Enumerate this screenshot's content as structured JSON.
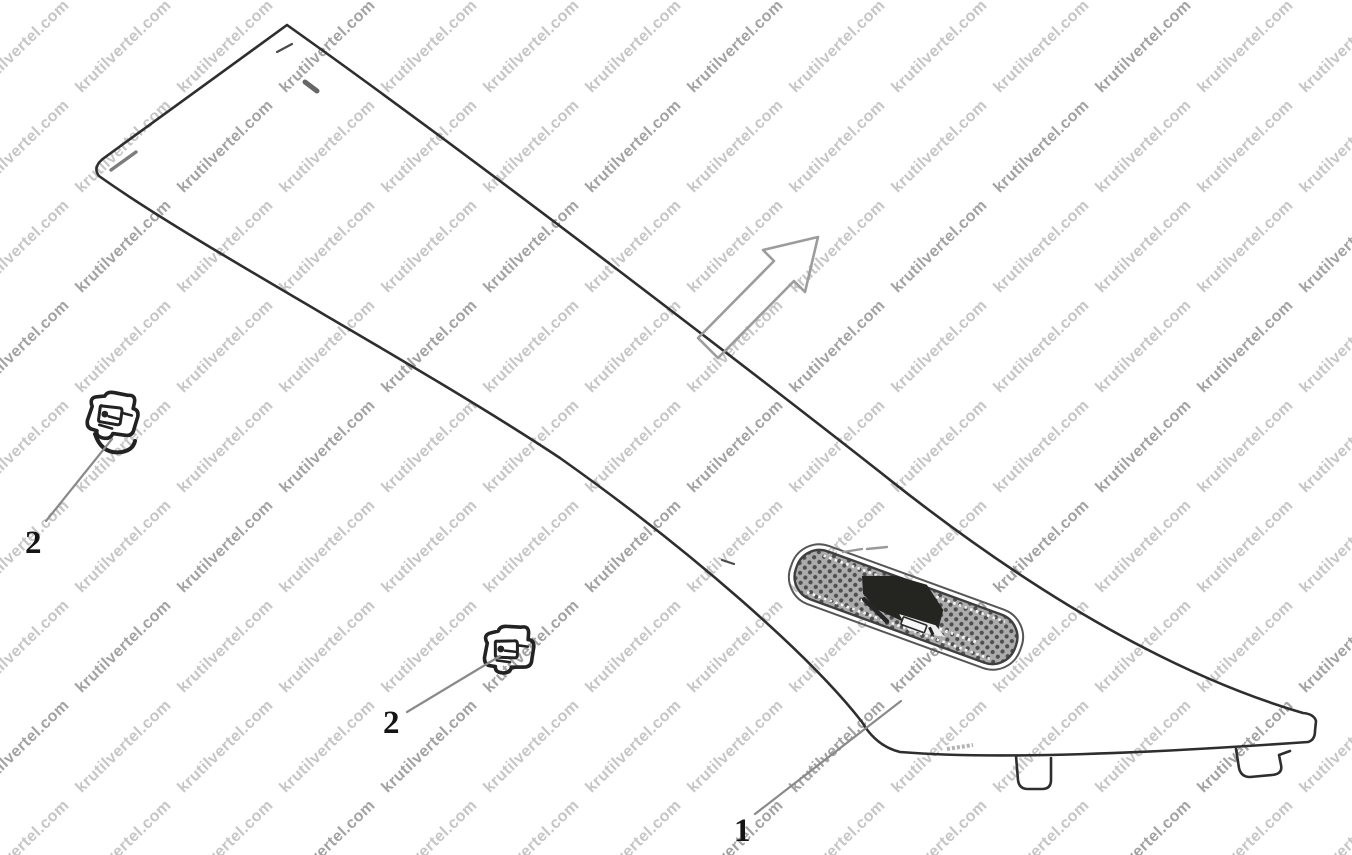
{
  "watermark": {
    "text": "krutilvertel.com",
    "color_light": "#c6c6c6",
    "color_dark": "#a2a2a2"
  },
  "callouts": {
    "part1_label": "1",
    "part2_upper_label": "2",
    "part2_lower_label": "2"
  },
  "colors": {
    "background": "#ffffff",
    "line": "#2e2e2e",
    "leader": "#8a8a8a",
    "arrow_outline": "#9c9c9c",
    "mesh_base": "#acacac",
    "mesh_dot": "#4e4e4e",
    "grille_shadow": "#242420"
  }
}
